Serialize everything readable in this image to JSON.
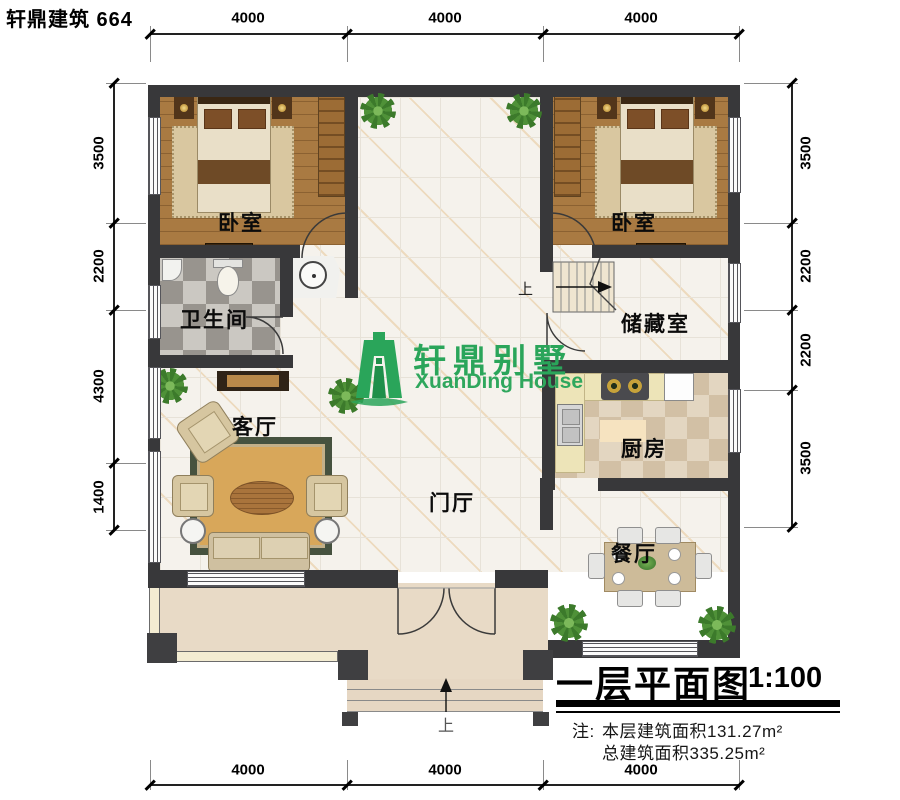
{
  "header": {
    "brand": "轩鼎建筑 664"
  },
  "logo": {
    "cn": "轩鼎别墅",
    "en": "XuanDing House",
    "color": "#2aa55a"
  },
  "rooms": {
    "bedroom_left": "卧室",
    "bedroom_right": "卧室",
    "bathroom": "卫生间",
    "storage": "储藏室",
    "kitchen": "厨房",
    "living": "客厅",
    "foyer": "门厅",
    "dining": "餐厅"
  },
  "stairs": {
    "up": "上"
  },
  "entry": {
    "up": "上"
  },
  "dimensions": {
    "top": [
      "4000",
      "4000",
      "4000"
    ],
    "bottom": [
      "4000",
      "4000",
      "4000"
    ],
    "left": [
      "3500",
      "2200",
      "4300",
      "1400"
    ],
    "right": [
      "3500",
      "2200",
      "2200",
      "3500"
    ]
  },
  "titleblock": {
    "title": "一层平面图",
    "scale": "1:100",
    "note_prefix": "注:",
    "note_line1": "本层建筑面积131.27m²",
    "note_line2": "总建筑面积335.25m²"
  },
  "colors": {
    "wall": "#38383a",
    "logo_green": "#2aa55a",
    "wood": "#a97a42",
    "terrace": "#e8dac6"
  }
}
